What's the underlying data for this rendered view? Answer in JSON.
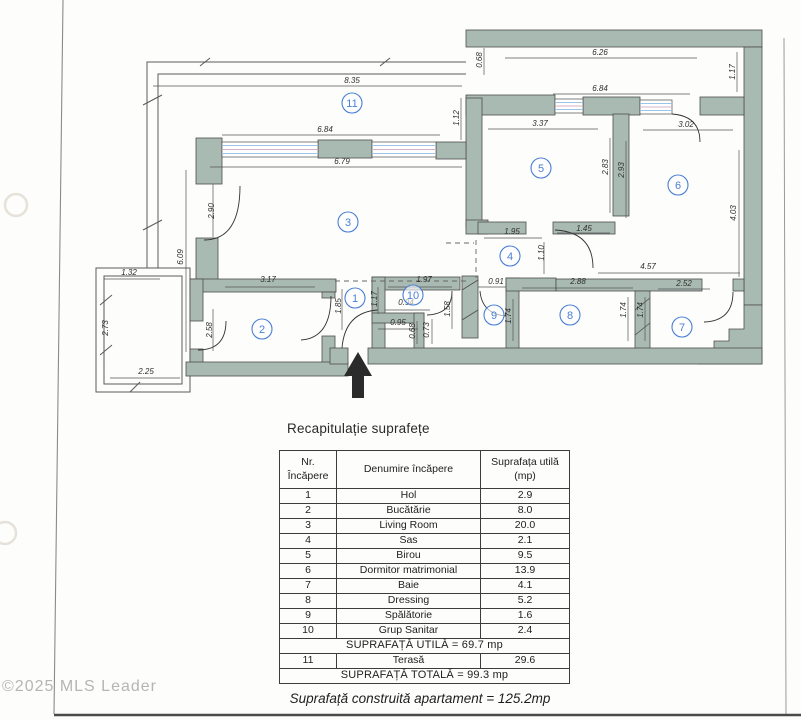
{
  "watermark": "©2025 MLS Leader",
  "floor_plan": {
    "wall_color": "#a9bab3",
    "window_line_color": "#9dc3e6",
    "room_label_color": "#4a7fd4",
    "entrance_arrow_icon": "up-arrow",
    "room_labels": [
      {
        "n": "1",
        "x": 355,
        "y": 298
      },
      {
        "n": "2",
        "x": 262,
        "y": 329
      },
      {
        "n": "3",
        "x": 348,
        "y": 222
      },
      {
        "n": "4",
        "x": 510,
        "y": 256
      },
      {
        "n": "5",
        "x": 541,
        "y": 168
      },
      {
        "n": "6",
        "x": 678,
        "y": 185
      },
      {
        "n": "7",
        "x": 682,
        "y": 327
      },
      {
        "n": "8",
        "x": 570,
        "y": 315
      },
      {
        "n": "9",
        "x": 494,
        "y": 315
      },
      {
        "n": "10",
        "x": 413,
        "y": 295
      },
      {
        "n": "11",
        "x": 352,
        "y": 103
      }
    ],
    "dimensions": [
      {
        "t": "8.35",
        "x": 352,
        "y": 83,
        "r": 0
      },
      {
        "t": "6.26",
        "x": 600,
        "y": 55,
        "r": 0
      },
      {
        "t": "0.68",
        "x": 482,
        "y": 60,
        "r": 90
      },
      {
        "t": "6.84",
        "x": 600,
        "y": 91,
        "r": 0
      },
      {
        "t": "1.17",
        "x": 735,
        "y": 72,
        "r": 90
      },
      {
        "t": "1.12",
        "x": 459,
        "y": 118,
        "r": 90
      },
      {
        "t": "6.84",
        "x": 325,
        "y": 132,
        "r": 0
      },
      {
        "t": "3.37",
        "x": 540,
        "y": 126,
        "r": 0
      },
      {
        "t": "3.02",
        "x": 686,
        "y": 127,
        "r": 0
      },
      {
        "t": "6.79",
        "x": 342,
        "y": 164,
        "r": 0
      },
      {
        "t": "2.90",
        "x": 214,
        "y": 211,
        "r": 90
      },
      {
        "t": "6.09",
        "x": 183,
        "y": 257,
        "r": 90
      },
      {
        "t": "2.83",
        "x": 608,
        "y": 167,
        "r": 90
      },
      {
        "t": "2.93",
        "x": 624,
        "y": 170,
        "r": 90
      },
      {
        "t": "4.03",
        "x": 736,
        "y": 213,
        "r": 90
      },
      {
        "t": "1.95",
        "x": 512,
        "y": 234,
        "r": 0
      },
      {
        "t": "1.10",
        "x": 544,
        "y": 253,
        "r": 90
      },
      {
        "t": "1.45",
        "x": 584,
        "y": 231,
        "r": 0
      },
      {
        "t": "4.57",
        "x": 648,
        "y": 269,
        "r": 0
      },
      {
        "t": "3.17",
        "x": 268,
        "y": 282,
        "r": 0
      },
      {
        "t": "1.97",
        "x": 424,
        "y": 282,
        "r": 0
      },
      {
        "t": "0.91",
        "x": 496,
        "y": 284,
        "r": 0
      },
      {
        "t": "2.88",
        "x": 578,
        "y": 284,
        "r": 0
      },
      {
        "t": "2.52",
        "x": 684,
        "y": 286,
        "r": 0
      },
      {
        "t": "1.32",
        "x": 129,
        "y": 275,
        "r": 0
      },
      {
        "t": "2.73",
        "x": 108,
        "y": 328,
        "r": 90
      },
      {
        "t": "2.25",
        "x": 146,
        "y": 374,
        "r": 0
      },
      {
        "t": "2.58",
        "x": 212,
        "y": 330,
        "r": 90
      },
      {
        "t": "1.85",
        "x": 341,
        "y": 306,
        "r": 90
      },
      {
        "t": "1.17",
        "x": 377,
        "y": 299,
        "r": 90
      },
      {
        "t": "1.58",
        "x": 450,
        "y": 309,
        "r": 90
      },
      {
        "t": "1.74",
        "x": 511,
        "y": 316,
        "r": 90
      },
      {
        "t": "0.94",
        "x": 406,
        "y": 305,
        "r": 0
      },
      {
        "t": "0.95",
        "x": 398,
        "y": 325,
        "r": 0
      },
      {
        "t": "0.68",
        "x": 415,
        "y": 331,
        "r": 90
      },
      {
        "t": "0.73",
        "x": 429,
        "y": 330,
        "r": 90
      },
      {
        "t": "1.74",
        "x": 626,
        "y": 310,
        "r": 90
      },
      {
        "t": "1.74",
        "x": 643,
        "y": 310,
        "r": 90
      }
    ]
  },
  "summary": {
    "title": "Recapitulație suprafețe",
    "columns": {
      "nr": [
        "Nr.",
        "Încăpere"
      ],
      "name": "Denumire încăpere",
      "area": [
        "Suprafața utilă",
        "(mp)"
      ]
    },
    "rows": [
      {
        "nr": "1",
        "name": "Hol",
        "area": "2.9"
      },
      {
        "nr": "2",
        "name": "Bucătărie",
        "area": "8.0"
      },
      {
        "nr": "3",
        "name": "Living Room",
        "area": "20.0"
      },
      {
        "nr": "4",
        "name": "Sas",
        "area": "2.1"
      },
      {
        "nr": "5",
        "name": "Birou",
        "area": "9.5"
      },
      {
        "nr": "6",
        "name": "Dormitor matrimonial",
        "area": "13.9"
      },
      {
        "nr": "7",
        "name": "Baie",
        "area": "4.1"
      },
      {
        "nr": "8",
        "name": "Dressing",
        "area": "5.2"
      },
      {
        "nr": "9",
        "name": "Spălătorie",
        "area": "1.6"
      },
      {
        "nr": "10",
        "name": "Grup Sanitar",
        "area": "2.4"
      }
    ],
    "utila_total": "SUPRAFAȚĂ UTILĂ = 69.7 mp",
    "terrace_row": {
      "nr": "11",
      "name": "Terasă",
      "area": "29.6"
    },
    "grand_total": "SUPRAFAȚĂ TOTALĂ = 99.3 mp",
    "built_area_caption": "Suprafață construită apartament = 125.2mp"
  }
}
